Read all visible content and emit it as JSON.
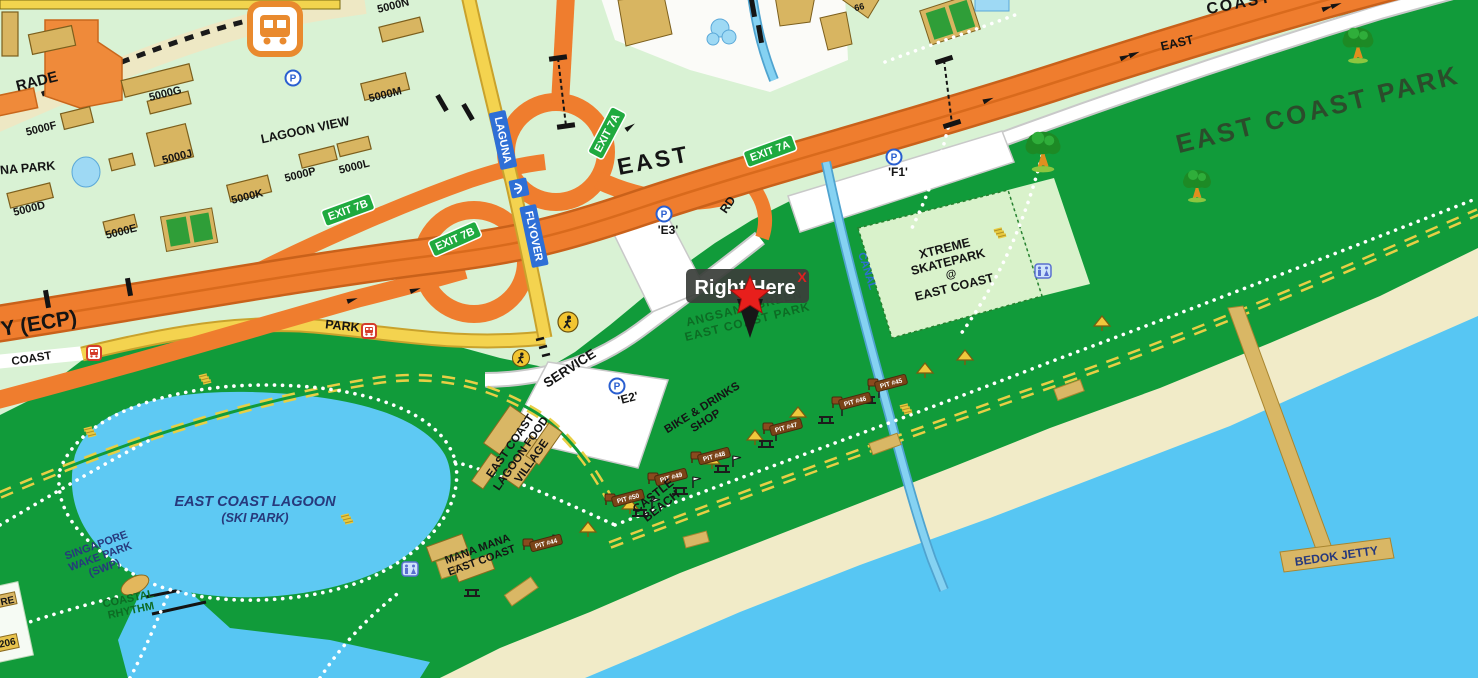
{
  "marker": {
    "label": "Right Here",
    "close_label": "X"
  },
  "roads": {
    "ecp": "Y (ECP)",
    "east_highway": "EAST",
    "coast_top_partial": "COAST",
    "coast_road": "COAST",
    "park_road": "PARK",
    "service_road": "SERVICE",
    "rd": "RD",
    "east_service": "EAST"
  },
  "signs": {
    "exit_7a": "EXIT 7A",
    "exit_7b": "EXIT 7B",
    "laguna": "LAGUNA",
    "flyover": "FLYOVER"
  },
  "areas": {
    "east_coast_park": "EAST COAST PARK",
    "xtreme_1": "XTREME",
    "xtreme_2": "SKATEPARK",
    "xtreme_3": "@",
    "xtreme_4": "EAST COAST",
    "angsana_1": "ANGSANA GREEN",
    "angsana_2": "EAST COAST PARK",
    "lagoon_1": "EAST COAST LAGOON",
    "lagoon_2": "(SKI PARK)",
    "swp_1": "SINGAPORE",
    "swp_2": "WAKE PARK",
    "swp_3": "(SWP)",
    "rhythm_1": "COASTAL",
    "rhythm_2": "RHYTHM",
    "mana_1": "MANA MANA",
    "mana_2": "EAST COAST",
    "castle_1": "CASTLE",
    "castle_2": "BEACH",
    "village_1": "EAST COAST",
    "village_2": "LAGOON FOOD",
    "village_3": "VILLAGE",
    "bike_1": "BIKE & DRINKS",
    "bike_2": "SHOP",
    "bedok_jetty": "BEDOK JETTY",
    "canal": "CANAL"
  },
  "buildings": {
    "b5000f": "5000F",
    "b5000g": "5000G",
    "b5000j": "5000J",
    "b5000k": "5000K",
    "b5000d": "5000D",
    "b5000e": "5000E",
    "b5000m": "5000M",
    "b5000n": "5000N",
    "b5000p": "5000P",
    "b5000l": "5000L",
    "lagoon_view": "LAGOON VIEW",
    "b66": "66"
  },
  "partials": {
    "parade": "RADE",
    "laguna_park": "NA PARK",
    "re": "RE",
    "n206": "206"
  },
  "carparks": {
    "e2": "'E2'",
    "e3": "'E3'",
    "f1": "'F1'",
    "parking_symbol": "P"
  },
  "pits": [
    "PIT #45",
    "PIT #46",
    "PIT #47",
    "PIT #48",
    "PIT #49",
    "PIT #50",
    "PIT #44"
  ],
  "colors": {
    "park_green": "#119b3a",
    "pale_green": "#d9f2d4",
    "sea_blue": "#57c6f3",
    "sand": "#f1ebc8",
    "highway_orange": "#ef7d2e",
    "road_yellow": "#f4d34f",
    "marker_red": "#e81f1c",
    "tooltip_bg": "#3a3e3a",
    "skatepark_green": "#d9f2cb"
  }
}
